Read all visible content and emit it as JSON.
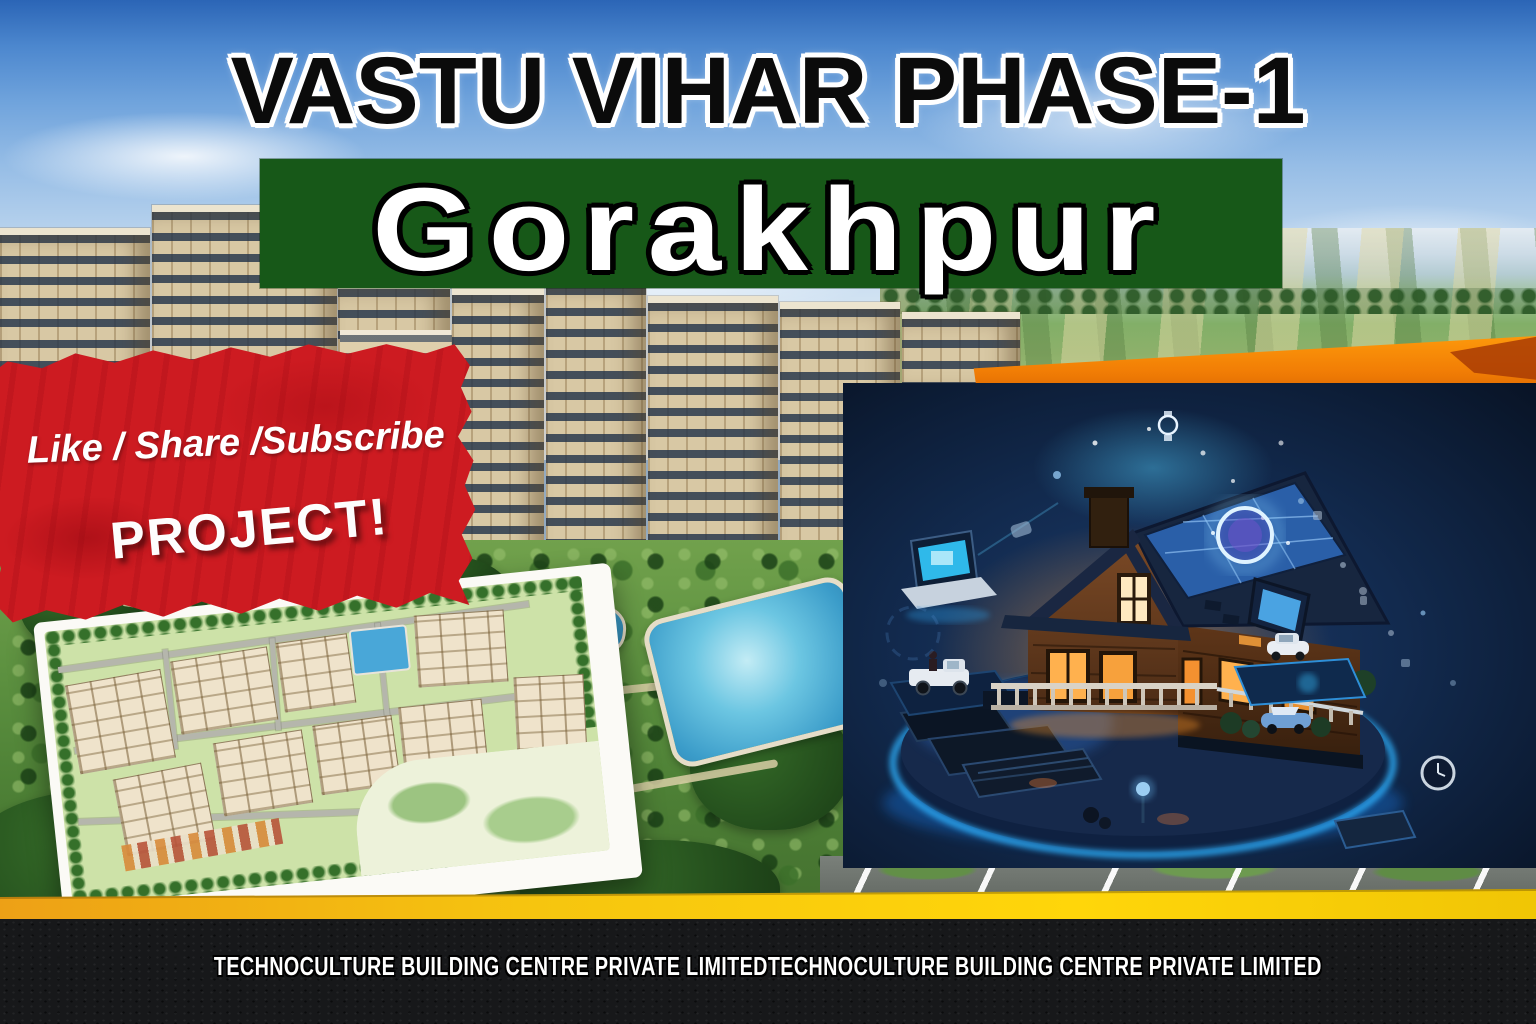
{
  "title": {
    "text": "VASTU VIHAR PHASE-1"
  },
  "banner": {
    "text": "Gorakhpur",
    "bg_color": "#175818"
  },
  "ribbon": {
    "line1": "Like / Share /Subscribe",
    "line2": "PROJECT!",
    "bg_color": "#cd1b21"
  },
  "footer": {
    "text": "TECHNOCULTURE BUILDING CENTRE PRIVATE LIMITEDTECHNOCULTURE BUILDING CENTRE PRIVATE LIMITED",
    "bg_color": "#17181a"
  },
  "accents": {
    "orange_band": "#f17d05",
    "yellow_band": "#ffd60a",
    "panel_navy": "#0b1730",
    "ribbon_red": "#cd1b21",
    "banner_green": "#175818"
  }
}
